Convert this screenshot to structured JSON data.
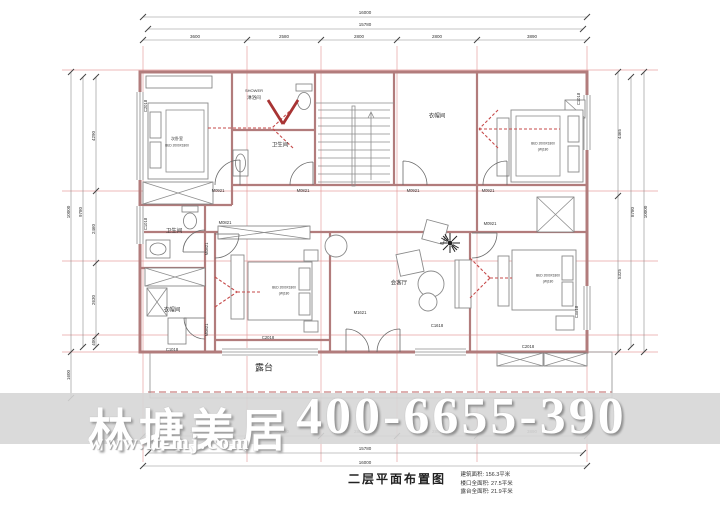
{
  "colors": {
    "wall": "#b27c7c",
    "grid": "#e39090",
    "band": "#d6d6d6",
    "red_mark": "#c64a4a",
    "text": "#333333"
  },
  "watermark": {
    "brand": "林塘美居",
    "url": "www.lt-mj.com",
    "phone": "400-6655-390"
  },
  "title_block": {
    "title": "二层平面布置图",
    "notes": [
      "建筑面积: 156.3平米",
      "楼口全面积: 27.5平米",
      "露台全面积: 21.9平米"
    ]
  },
  "plan": {
    "labels": [
      {
        "n": "dim-top-total",
        "t": "16000",
        "x": 365,
        "y": 13
      },
      {
        "n": "dim-top-inner",
        "t": "15780",
        "x": 365,
        "y": 25
      },
      {
        "n": "dim-top-bay",
        "t": "3600",
        "x": 195,
        "y": 37
      },
      {
        "n": "dim-top-bay",
        "t": "2580",
        "x": 284,
        "y": 37
      },
      {
        "n": "dim-top-bay",
        "t": "2800",
        "x": 359,
        "y": 37
      },
      {
        "n": "dim-top-bay",
        "t": "2800",
        "x": 437,
        "y": 37
      },
      {
        "n": "dim-top-bay",
        "t": "3890",
        "x": 532,
        "y": 37
      },
      {
        "n": "dim-bottom-bay",
        "t": "3600",
        "x": 195,
        "y": 432
      },
      {
        "n": "dim-bottom-bay",
        "t": "2580",
        "x": 284,
        "y": 432
      },
      {
        "n": "dim-bottom-bay",
        "t": "2800",
        "x": 359,
        "y": 432
      },
      {
        "n": "dim-bottom-bay",
        "t": "2800",
        "x": 437,
        "y": 432
      },
      {
        "n": "dim-bottom-bay",
        "t": "3890",
        "x": 532,
        "y": 432
      },
      {
        "n": "dim-bottom-inner",
        "t": "15780",
        "x": 365,
        "y": 449
      },
      {
        "n": "dim-bottom-total",
        "t": "16000",
        "x": 365,
        "y": 463
      },
      {
        "n": "dim-left-total",
        "t": "10000",
        "x": 69,
        "y": 212,
        "r": -90
      },
      {
        "n": "dim-left-inner",
        "t": "9780",
        "x": 81,
        "y": 212,
        "r": -90
      },
      {
        "n": "dim-left-bay",
        "t": "4290",
        "x": 94,
        "y": 136,
        "r": -90
      },
      {
        "n": "dim-left-bay",
        "t": "2460",
        "x": 94,
        "y": 229,
        "r": -90
      },
      {
        "n": "dim-left-bay",
        "t": "2630",
        "x": 94,
        "y": 300,
        "r": -90
      },
      {
        "n": "dim-left-bay",
        "t": "400",
        "x": 94,
        "y": 342,
        "r": -90
      },
      {
        "n": "dim-left-terrace",
        "t": "1600",
        "x": 69,
        "y": 375,
        "r": -90
      },
      {
        "n": "dim-right-bay",
        "t": "4465",
        "x": 620,
        "y": 134,
        "r": -90
      },
      {
        "n": "dim-right-bay",
        "t": "5325",
        "x": 620,
        "y": 274,
        "r": -90
      },
      {
        "n": "dim-right-inner",
        "t": "8780",
        "x": 633,
        "y": 212,
        "r": -90
      },
      {
        "n": "dim-right-total",
        "t": "10000",
        "x": 646,
        "y": 212,
        "r": -90
      },
      {
        "n": "room-label-shower-en",
        "t": "SHOWER",
        "x": 254,
        "y": 91,
        "s": 4
      },
      {
        "n": "room-label-shower",
        "t": "淋浴间",
        "x": 254,
        "y": 98,
        "s": 4.5
      },
      {
        "n": "room-label-bathroom-top",
        "t": "卫生间",
        "x": 280,
        "y": 146,
        "s": 5.5
      },
      {
        "n": "room-label-cloakroom-top",
        "t": "衣帽间",
        "x": 437,
        "y": 117,
        "s": 5.5
      },
      {
        "n": "room-label-bathroom-left",
        "t": "卫生间",
        "x": 174,
        "y": 232,
        "s": 5.5
      },
      {
        "n": "room-label-cloakroom-left",
        "t": "衣帽间",
        "x": 172,
        "y": 311,
        "s": 5.5
      },
      {
        "n": "room-label-lounge",
        "t": "会客厅",
        "x": 399,
        "y": 284,
        "s": 5.5
      },
      {
        "n": "room-label-terrace",
        "t": "露台",
        "x": 264,
        "y": 368,
        "s": 9
      },
      {
        "n": "bed-label",
        "t": "次卧室",
        "x": 177,
        "y": 139,
        "s": 4
      },
      {
        "n": "bed-label",
        "t": "BED 2000X1800",
        "x": 177,
        "y": 146,
        "s": 3.2
      },
      {
        "n": "bed-label",
        "t": "BED 2000X1800",
        "x": 543,
        "y": 144,
        "s": 3.2
      },
      {
        "n": "bed-label",
        "t": "(W)180",
        "x": 543,
        "y": 150,
        "s": 3.2
      },
      {
        "n": "bed-label",
        "t": "BED 2000X1800",
        "x": 284,
        "y": 288,
        "s": 3.2
      },
      {
        "n": "bed-label",
        "t": "(W)180",
        "x": 284,
        "y": 294,
        "s": 3.2
      },
      {
        "n": "bed-label",
        "t": "BED 2000X1800",
        "x": 548,
        "y": 276,
        "s": 3.2
      },
      {
        "n": "bed-label",
        "t": "(W)180",
        "x": 548,
        "y": 282,
        "s": 3.2
      },
      {
        "n": "door-label",
        "t": "M0921",
        "x": 218,
        "y": 191,
        "s": 4.2
      },
      {
        "n": "door-label",
        "t": "M0821",
        "x": 303,
        "y": 191,
        "s": 4.2
      },
      {
        "n": "door-label",
        "t": "M0921",
        "x": 413,
        "y": 191,
        "s": 4.2
      },
      {
        "n": "door-label",
        "t": "M0921",
        "x": 488,
        "y": 191,
        "s": 4.2
      },
      {
        "n": "door-label",
        "t": "M0821",
        "x": 225,
        "y": 223,
        "s": 4.2
      },
      {
        "n": "door-label",
        "t": "M0921",
        "x": 490,
        "y": 224,
        "s": 4.2
      },
      {
        "n": "door-label",
        "t": "M1621",
        "x": 360,
        "y": 313,
        "s": 4.2
      },
      {
        "n": "door-label",
        "t": "M0821",
        "x": 207,
        "y": 249,
        "r": -90,
        "s": 4.2
      },
      {
        "n": "door-label",
        "t": "M0821",
        "x": 207,
        "y": 330,
        "r": -90,
        "s": 4.2
      },
      {
        "n": "window-label",
        "t": "C2018",
        "x": 146,
        "y": 106,
        "r": -90,
        "s": 4.2
      },
      {
        "n": "window-label",
        "t": "C1018",
        "x": 146,
        "y": 224,
        "r": -90,
        "s": 4.2
      },
      {
        "n": "window-label",
        "t": "C1018",
        "x": 172,
        "y": 350,
        "s": 4.2
      },
      {
        "n": "window-label",
        "t": "C2018",
        "x": 268,
        "y": 338,
        "s": 4.2
      },
      {
        "n": "window-label",
        "t": "C1618",
        "x": 437,
        "y": 326,
        "s": 4.2
      },
      {
        "n": "window-label",
        "t": "C2018",
        "x": 528,
        "y": 347,
        "s": 4.2
      },
      {
        "n": "window-label",
        "t": "C0818",
        "x": 577,
        "y": 312,
        "r": -90,
        "s": 4.2
      },
      {
        "n": "window-label",
        "t": "C1018",
        "x": 579,
        "y": 99,
        "r": -90,
        "s": 4.2
      }
    ]
  }
}
